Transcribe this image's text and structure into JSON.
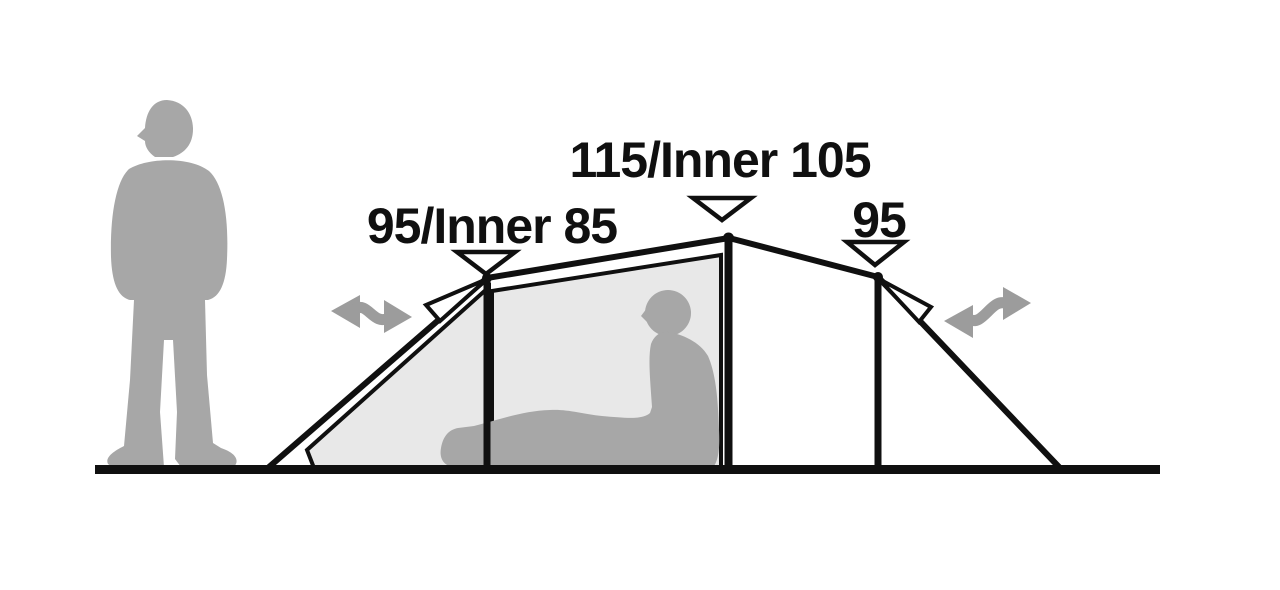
{
  "diagram": {
    "labels": {
      "front": "95/Inner 85",
      "middle": "115/Inner 105",
      "rear": "95"
    },
    "colors": {
      "line": "#101010",
      "text": "#101010",
      "silhouette": "#a7a7a7",
      "arrow": "#9c9c9c",
      "panel": "#e8e8e8",
      "marker_fill": "#ffffff",
      "background": "#ffffff"
    }
  }
}
